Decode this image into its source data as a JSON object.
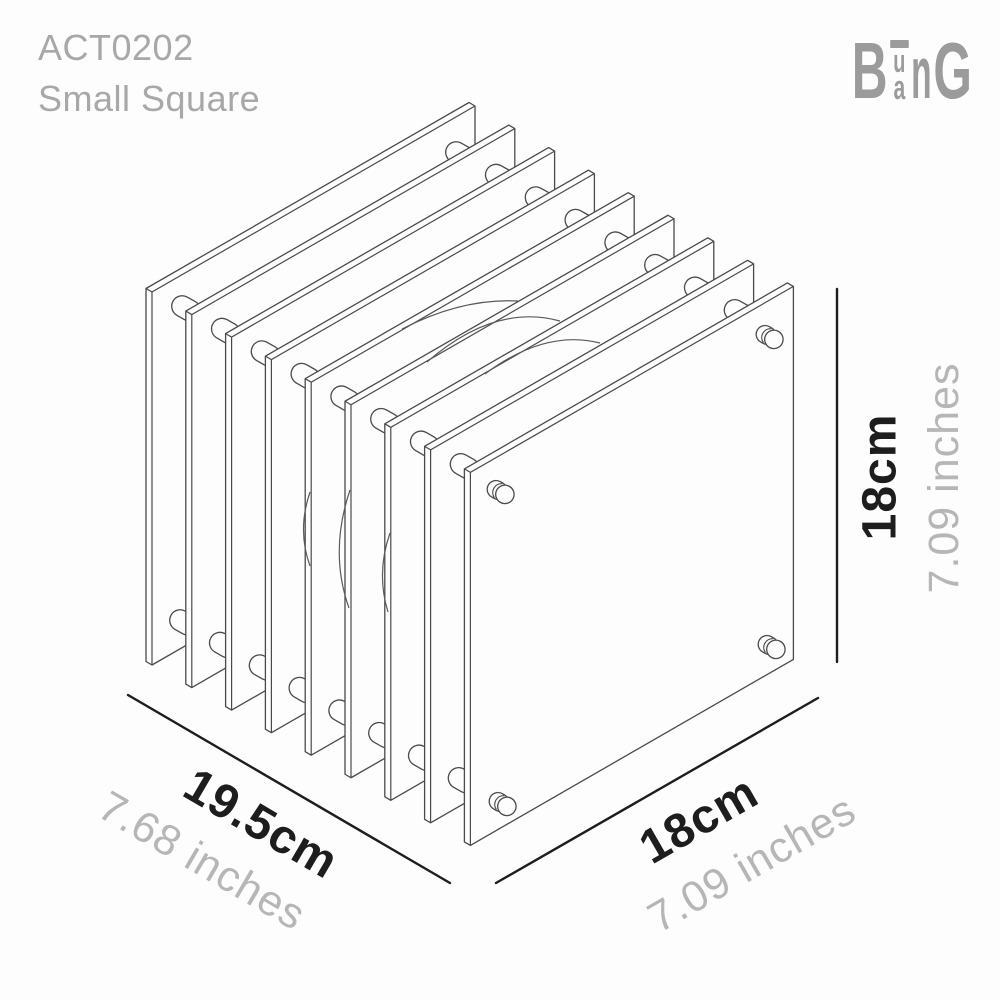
{
  "header": {
    "product_code": "ACT0202",
    "product_name": "Small Square"
  },
  "logo": {
    "letter_b": "B",
    "letter_u": "u",
    "letter_a": "a",
    "letter_n": "n",
    "letter_g": "G"
  },
  "dimensions": {
    "height": {
      "cm": "18cm",
      "inches": "7.09 inches"
    },
    "depth": {
      "cm": "19.5cm",
      "inches": "7.68 inches"
    },
    "width": {
      "cm": "18cm",
      "inches": "7.09 inches"
    }
  },
  "diagram": {
    "panel_count": 9
  },
  "colors": {
    "dark_text": "#1d1d1d",
    "muted_text": "#a8a8a8",
    "inches_text": "#b6b6b6",
    "logo_gray": "#9b9b9b",
    "line": "#4a4a4a",
    "background": "#fdfdfd"
  }
}
